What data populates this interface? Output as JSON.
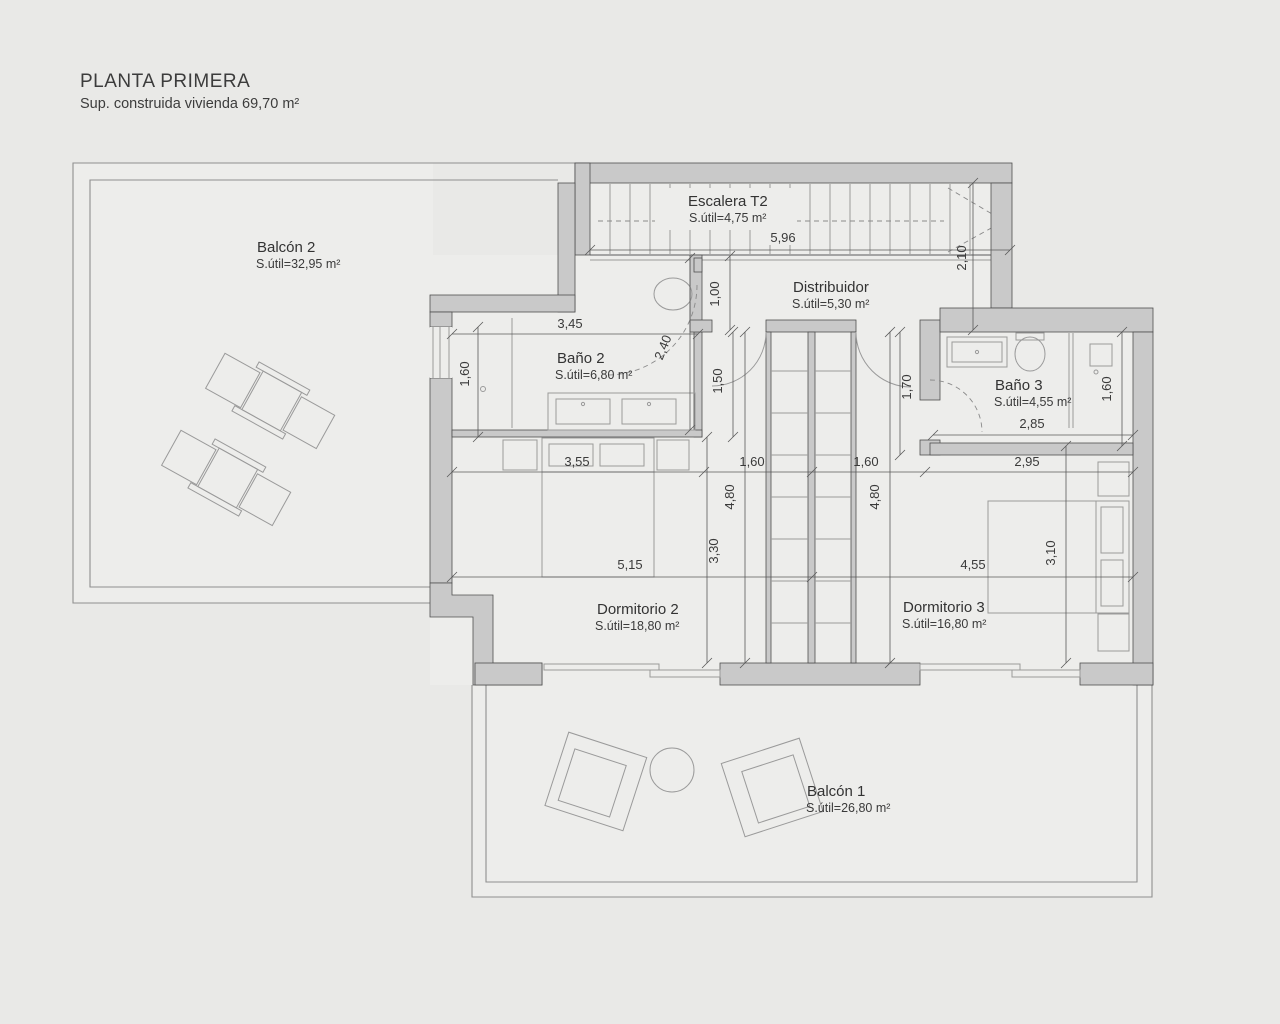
{
  "title": {
    "heading": "PLANTA PRIMERA",
    "subtitle": "Sup. construida vivienda 69,70 m²"
  },
  "rooms": {
    "balcon2": {
      "name": "Balcón 2",
      "area": "S.útil=32,95 m²"
    },
    "escalera": {
      "name": "Escalera T2",
      "area": "S.útil=4,75 m²"
    },
    "distribuidor": {
      "name": "Distribuidor",
      "area": "S.útil=5,30 m²"
    },
    "bano2": {
      "name": "Baño 2",
      "area": "S.útil=6,80 m²"
    },
    "bano3": {
      "name": "Baño 3",
      "area": "S.útil=4,55 m²"
    },
    "dormitorio2": {
      "name": "Dormitorio 2",
      "area": "S.útil=18,80 m²"
    },
    "dormitorio3": {
      "name": "Dormitorio 3",
      "area": "S.útil=16,80 m²"
    },
    "balcon1": {
      "name": "Balcón 1",
      "area": "S.útil=26,80 m²"
    }
  },
  "dims": {
    "stairs_w": "5,96",
    "hall_h_right": "2,10",
    "hall_h_left": "1,00",
    "bano2_w": "3,45",
    "bano2_left_h": "1,60",
    "bano2_right_h": "2,40",
    "vestibule2_h": "1,50",
    "vestibule3_h": "1,70",
    "bano3_w": "2,85",
    "bano3_right_h": "1,60",
    "dorm2_top_w": "3,55",
    "closet_left_w": "1,60",
    "closet_right_w": "1,60",
    "dorm3_top_w": "2,95",
    "dorm2_h": "4,80",
    "dorm3_h": "4,80",
    "dorm2_lower_h": "3,30",
    "dorm2_w": "5,15",
    "dorm3_w": "4,55",
    "dorm3_bed_h": "3,10"
  }
}
